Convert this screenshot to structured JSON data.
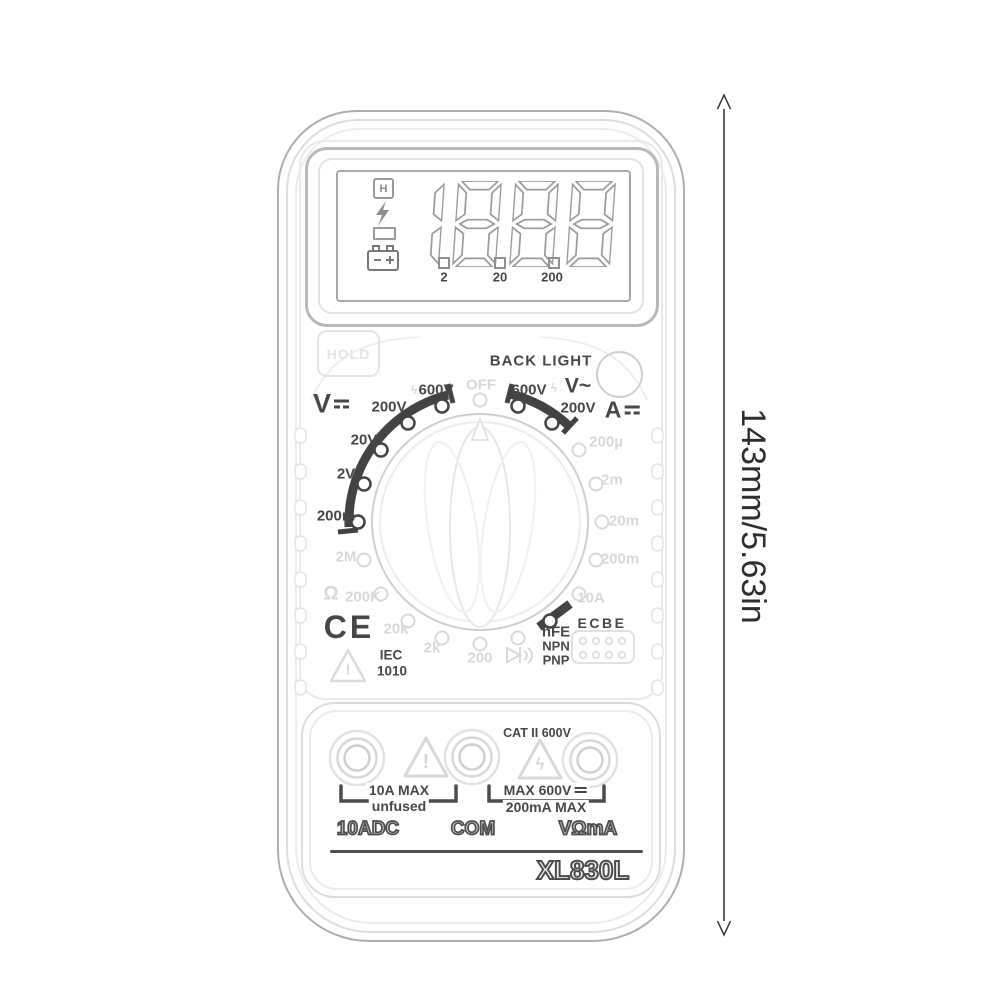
{
  "product": {
    "model": "XL830L",
    "dimension_label": "143mm/5.63in"
  },
  "lcd": {
    "digits": "1888",
    "hold_annunciator": "H",
    "annunciator_icons": [
      "hold-square-icon",
      "lightning-icon",
      "minus-icon",
      "battery-icon"
    ],
    "range_markers": [
      "2",
      "20",
      "200"
    ]
  },
  "buttons": {
    "hold": "HOLD",
    "backlight": "BACK LIGHT"
  },
  "dial": {
    "v_dc": "V",
    "a_dc": "A",
    "v_ac": "V~",
    "ohm": "Ω",
    "npn": "NPN",
    "pnp": "PNP",
    "ecbe": "ECBE",
    "hv_bolt": "ϟ",
    "positions": [
      {
        "name": "off",
        "label": "OFF",
        "dark": false,
        "dot": [
          480,
          400
        ],
        "lbl": [
          481,
          385
        ]
      },
      {
        "name": "vdc-600v",
        "label": "600V",
        "dark": true,
        "dot": [
          442,
          406
        ],
        "lbl": [
          436,
          390
        ]
      },
      {
        "name": "vdc-200v",
        "label": "200V",
        "dark": true,
        "dot": [
          408,
          423
        ],
        "lbl": [
          389,
          407
        ]
      },
      {
        "name": "vdc-20v",
        "label": "20V",
        "dark": true,
        "dot": [
          381,
          450
        ],
        "lbl": [
          364,
          440
        ]
      },
      {
        "name": "vdc-2v",
        "label": "2V",
        "dark": true,
        "dot": [
          364,
          484
        ],
        "lbl": [
          346,
          474
        ]
      },
      {
        "name": "vdc-200m",
        "label": "200m",
        "dark": true,
        "dot": [
          358,
          522
        ],
        "lbl": [
          336,
          516
        ]
      },
      {
        "name": "res-2m",
        "label": "2M",
        "dark": false,
        "dot": [
          364,
          560
        ],
        "lbl": [
          346,
          557
        ]
      },
      {
        "name": "res-200k",
        "label": "200K",
        "dark": false,
        "dot": [
          381,
          594
        ],
        "lbl": [
          363,
          597
        ]
      },
      {
        "name": "res-20k",
        "label": "20k",
        "dark": false,
        "dot": [
          408,
          621
        ],
        "lbl": [
          396,
          629
        ]
      },
      {
        "name": "res-2k",
        "label": "2k",
        "dark": false,
        "dot": [
          442,
          638
        ],
        "lbl": [
          432,
          648
        ]
      },
      {
        "name": "res-200",
        "label": "200",
        "dark": false,
        "dot": [
          480,
          644
        ],
        "lbl": [
          480,
          658
        ]
      },
      {
        "name": "diode-buzzer",
        "label": "",
        "dark": false,
        "dot": [
          518,
          638
        ],
        "lbl": [
          519,
          655
        ]
      },
      {
        "name": "hfe",
        "label": "hFE",
        "dark": true,
        "dot": [
          550,
          621
        ],
        "lbl": [
          556,
          632
        ]
      },
      {
        "name": "adc-10a",
        "label": "10A",
        "dark": false,
        "dot": [
          579,
          594
        ],
        "lbl": [
          591,
          598
        ]
      },
      {
        "name": "adc-200m",
        "label": "200m",
        "dark": false,
        "dot": [
          596,
          560
        ],
        "lbl": [
          620,
          559
        ]
      },
      {
        "name": "adc-20m",
        "label": "20m",
        "dark": false,
        "dot": [
          602,
          522
        ],
        "lbl": [
          624,
          521
        ]
      },
      {
        "name": "adc-2m",
        "label": "2m",
        "dark": false,
        "dot": [
          596,
          484
        ],
        "lbl": [
          612,
          480
        ]
      },
      {
        "name": "adc-200u",
        "label": "200µ",
        "dark": false,
        "dot": [
          579,
          450
        ],
        "lbl": [
          606,
          442
        ]
      },
      {
        "name": "vac-200v",
        "label": "200V",
        "dark": true,
        "dot": [
          552,
          423
        ],
        "lbl": [
          578,
          408
        ]
      },
      {
        "name": "vac-600v",
        "label": "600V",
        "dark": true,
        "dot": [
          518,
          406
        ],
        "lbl": [
          529,
          390
        ]
      }
    ]
  },
  "certifications": {
    "ce": "CE",
    "iec": "IEC",
    "iec_num": "1010"
  },
  "glyphs": {
    "warning": "!",
    "bolt": "ϟ"
  },
  "terminals": {
    "cat": "CAT II 600V",
    "note_left_1": "10A MAX",
    "note_left_2": "unfused",
    "note_right_1": "MAX 600V",
    "note_right_2": "200mA MAX",
    "jack_left": "10ADC",
    "jack_center": "COM",
    "jack_right": "VΩmA"
  },
  "colors": {
    "dark_print": "#474747",
    "faint_print": "#d7d7d7",
    "lcd_stroke": "#9a9a9a",
    "arrow": "#3a3a3a"
  }
}
